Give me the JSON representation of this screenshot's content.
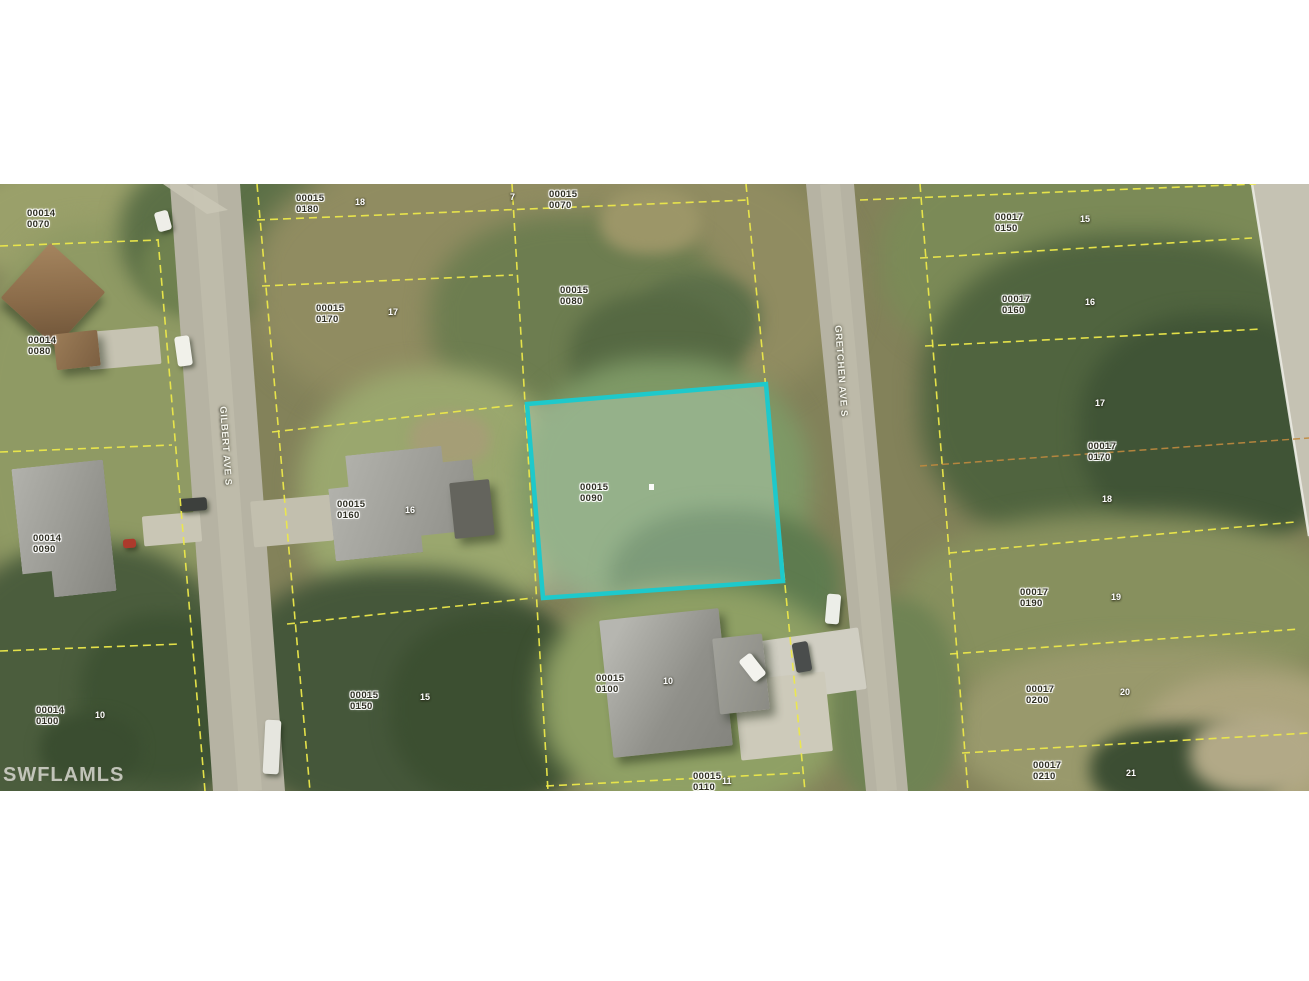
{
  "watermark": "SWFLAMLS",
  "map": {
    "streets": [
      {
        "name": "GILBERT AVE S"
      },
      {
        "name": "GRETCHEN AVE S"
      }
    ],
    "highlighted_parcel": {
      "block": "00015",
      "lot": "0090"
    },
    "parcel_labels": [
      {
        "block": "00014",
        "lot": "0070",
        "x": 27,
        "y": 25
      },
      {
        "block": "00014",
        "lot": "0080",
        "x": 28,
        "y": 152
      },
      {
        "block": "00014",
        "lot": "0090",
        "x": 33,
        "y": 350
      },
      {
        "block": "00014",
        "lot": "0100",
        "x": 36,
        "y": 522
      },
      {
        "block": "00015",
        "lot": "0180",
        "x": 296,
        "y": 10
      },
      {
        "block": "00015",
        "lot": "0170",
        "x": 316,
        "y": 120
      },
      {
        "block": "00015",
        "lot": "0160",
        "x": 337,
        "y": 316
      },
      {
        "block": "00015",
        "lot": "0150",
        "x": 350,
        "y": 507
      },
      {
        "block": "00015",
        "lot": "0070",
        "x": 549,
        "y": 6
      },
      {
        "block": "00015",
        "lot": "0080",
        "x": 560,
        "y": 102
      },
      {
        "block": "00015",
        "lot": "0090",
        "x": 580,
        "y": 299
      },
      {
        "block": "00015",
        "lot": "0100",
        "x": 596,
        "y": 490
      },
      {
        "block": "00015",
        "lot": "0110",
        "x": 693,
        "y": 588
      },
      {
        "block": "00017",
        "lot": "0150",
        "x": 995,
        "y": 29
      },
      {
        "block": "00017",
        "lot": "0160",
        "x": 1002,
        "y": 111
      },
      {
        "block": "00017",
        "lot": "0170",
        "x": 1088,
        "y": 258
      },
      {
        "block": "00017",
        "lot": "0190",
        "x": 1020,
        "y": 404
      },
      {
        "block": "00017",
        "lot": "0200",
        "x": 1026,
        "y": 501
      },
      {
        "block": "00017",
        "lot": "0210",
        "x": 1033,
        "y": 577
      }
    ],
    "lot_numbers": [
      {
        "n": "7",
        "x": 510,
        "y": 8
      },
      {
        "n": "18",
        "x": 355,
        "y": 13
      },
      {
        "n": "17",
        "x": 388,
        "y": 123
      },
      {
        "n": "16",
        "x": 405,
        "y": 321
      },
      {
        "n": "15",
        "x": 420,
        "y": 508
      },
      {
        "n": "10",
        "x": 663,
        "y": 492
      },
      {
        "n": "11",
        "x": 722,
        "y": 592
      },
      {
        "n": "10",
        "x": 95,
        "y": 526
      },
      {
        "n": "15",
        "x": 1080,
        "y": 30
      },
      {
        "n": "16",
        "x": 1085,
        "y": 113
      },
      {
        "n": "17",
        "x": 1095,
        "y": 214
      },
      {
        "n": "18",
        "x": 1102,
        "y": 310
      },
      {
        "n": "19",
        "x": 1111,
        "y": 408
      },
      {
        "n": "20",
        "x": 1120,
        "y": 503
      },
      {
        "n": "21",
        "x": 1126,
        "y": 584
      }
    ],
    "colors": {
      "boundary_line": "#ece84a",
      "secondary_boundary_line": "#c08a3e",
      "highlight_outline": "#1ec9cb",
      "road": "#b6b3a3",
      "label_text": "#2e2e22",
      "lot_number_text": "#ffffff",
      "street_text": "#f6f6ee",
      "watermark_text": "#d8d8d0"
    }
  }
}
